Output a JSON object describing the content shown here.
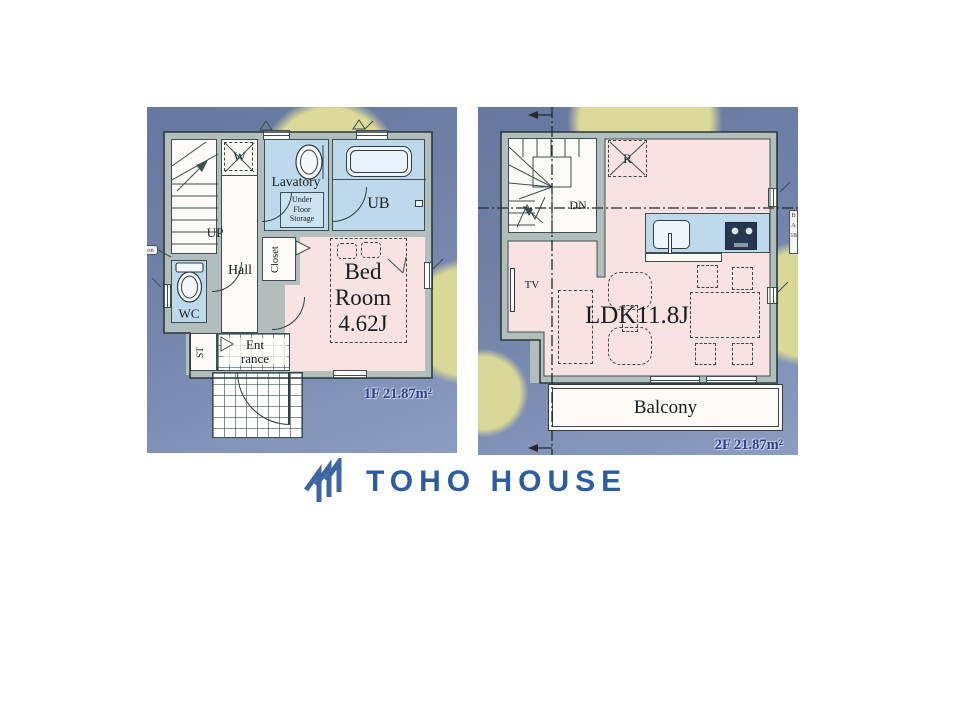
{
  "floor1": {
    "stairs_label": "UP",
    "w_label": "W",
    "lavatory_label": "Lavatory",
    "storage_lines": [
      "Under",
      "Floor",
      "Storage"
    ],
    "ub_label": "UB",
    "hall_label": "Hall",
    "closet_label": "Closet",
    "bed_lines": [
      "Bed",
      "Room",
      "4.62J"
    ],
    "wc_label": "WC",
    "st_label": "ST",
    "entrance_lines": [
      "Ent",
      "rance"
    ],
    "area_label": "1F 21.87m²",
    "edge_note": "on"
  },
  "floor2": {
    "refrigerator_label": "R",
    "down_label": "DN",
    "tv_label": "TV",
    "ldk_label": "LDK11.8J",
    "balcony_label": "Balcony",
    "area_label": "2F 21.87m²",
    "edge_note": "BA18"
  },
  "logo": {
    "text": "TOHO HOUSE"
  },
  "colors": {
    "brand_blue": "#2d5d9e",
    "panel_blue": "#7283aa",
    "accent_yellow": "#dbda99",
    "room_pink": "#f8e3e2",
    "room_blue": "#bed9ec",
    "wall_gray": "#b1bebb",
    "area_label_navy": "#2b3f86"
  }
}
